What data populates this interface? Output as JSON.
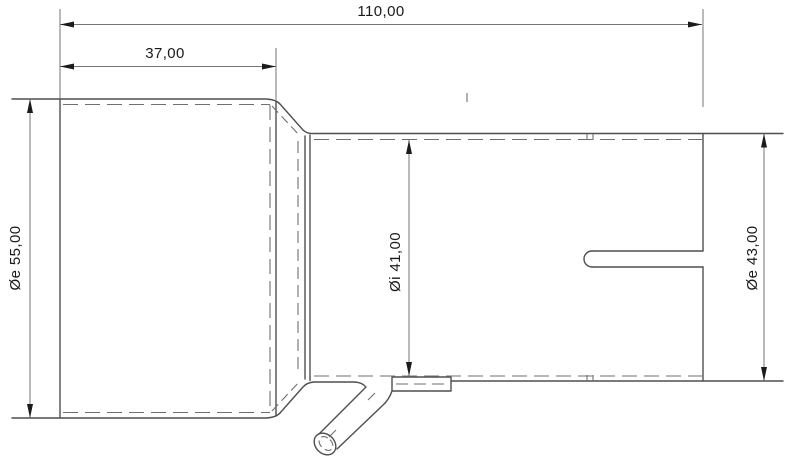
{
  "drawing": {
    "description": "2D technical side view of a tube reducer adapter with angled drain stub",
    "background": "#ffffff",
    "colors": {
      "outline": "#4f4f4f",
      "hidden_line": "#6f6f6f",
      "dimension_line": "#757575",
      "arrowhead": "#1b1b1b",
      "text": "#1a1a1a"
    },
    "dimensions": {
      "overall_length": "110,00",
      "large_section_length": "37,00",
      "large_outer_diameter": "Øe 55,00",
      "bore_inner_diameter": "Øi 41,00",
      "small_outer_diameter": "Øe 43,00"
    }
  }
}
